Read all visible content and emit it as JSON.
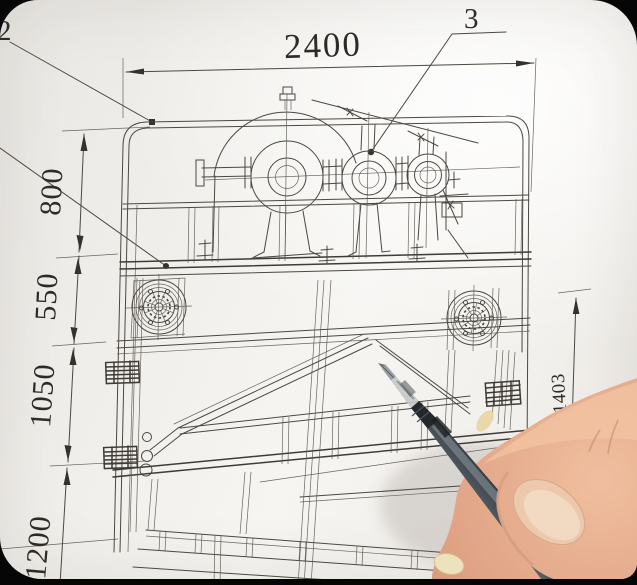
{
  "scene": {
    "callouts": {
      "left": "2",
      "top": "3"
    },
    "dimensions": {
      "width": "2400",
      "left": [
        "800",
        "550",
        "1050",
        "1200"
      ],
      "right": "1403"
    },
    "colors": {
      "paper": "#f3f1ee",
      "line": "#4c4841",
      "ink": "#2e2b26",
      "pen_barrel": "#49525a",
      "skin": "#e3aa8a",
      "background": "#070606"
    }
  }
}
